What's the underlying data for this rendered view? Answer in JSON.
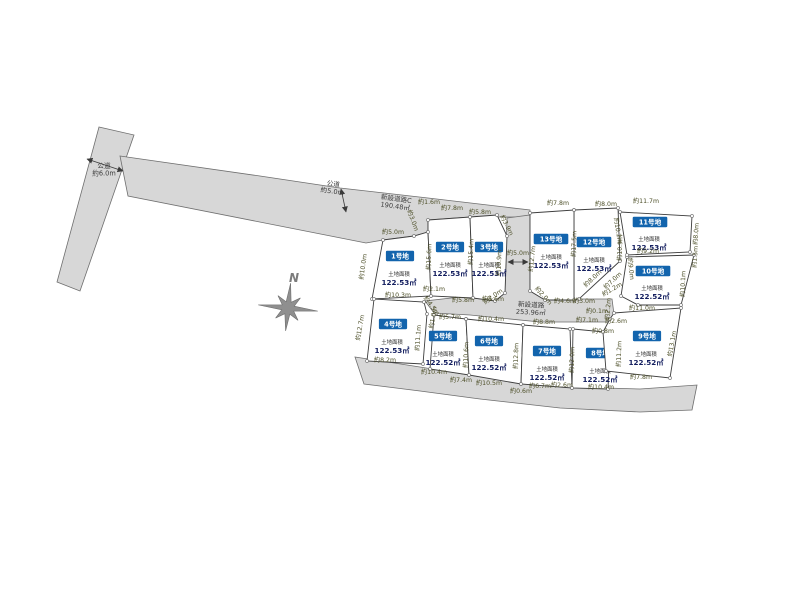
{
  "compass": {
    "label": "N"
  },
  "colors": {
    "road_fill": "#d7d7d7",
    "road_stroke": "#6e6e6e",
    "plot_fill": "#ffffff",
    "plot_stroke": "#3d3d3d",
    "chip_bg": "#1264ad",
    "chip_text": "#ffffff",
    "dim_text": "#4d4f28",
    "area_value_text": "#121d5e",
    "compass_gray": "#8f8f8f"
  },
  "roads": [
    {
      "name": "public-road-6m-band",
      "points": [
        [
          99,
          127
        ],
        [
          134,
          135
        ],
        [
          80,
          291
        ],
        [
          57,
          282
        ]
      ]
    },
    {
      "name": "public-road-5m-upper",
      "points": [
        [
          120,
          156
        ],
        [
          260,
          176
        ],
        [
          340,
          188
        ],
        [
          428,
          198
        ],
        [
          530,
          210
        ],
        [
          530,
          217
        ],
        [
          470,
          217
        ],
        [
          428,
          220
        ],
        [
          428,
          232
        ],
        [
          414,
          236
        ],
        [
          383,
          240
        ],
        [
          366,
          243
        ],
        [
          128,
          196
        ]
      ]
    },
    {
      "name": "new-road-vertical-and-middle",
      "points": [
        [
          507,
          218
        ],
        [
          530,
          215
        ],
        [
          530,
          291
        ],
        [
          545,
          300
        ],
        [
          565,
          299
        ],
        [
          612,
          299
        ],
        [
          615,
          322
        ],
        [
          540,
          322
        ],
        [
          470,
          315
        ],
        [
          434,
          313
        ],
        [
          425,
          301
        ],
        [
          460,
          297
        ],
        [
          492,
          300
        ],
        [
          505,
          291
        ]
      ]
    },
    {
      "name": "south-boundary-road-band",
      "points": [
        [
          355,
          357
        ],
        [
          420,
          367
        ],
        [
          500,
          380
        ],
        [
          570,
          387
        ],
        [
          640,
          389
        ],
        [
          697,
          385
        ],
        [
          692,
          410
        ],
        [
          640,
          412
        ],
        [
          560,
          408
        ],
        [
          480,
          399
        ],
        [
          420,
          391
        ],
        [
          364,
          384
        ]
      ]
    }
  ],
  "road_labels": [
    {
      "name": "public-road-6m-label",
      "lines": [
        "公道",
        "約6.0m"
      ],
      "x": 104,
      "y": 168,
      "r": 0
    },
    {
      "name": "public-road-5m-label",
      "lines": [
        "公道",
        "約5.0m"
      ],
      "x": 333,
      "y": 186,
      "r": 8
    },
    {
      "name": "new-road-c-label",
      "lines": [
        "新設道路C",
        "190.48㎡"
      ],
      "x": 396,
      "y": 201,
      "r": 8
    },
    {
      "name": "new-road-label",
      "lines": [
        "新設道路",
        "253.96㎡"
      ],
      "x": 531,
      "y": 307,
      "r": 3
    }
  ],
  "plots": [
    {
      "id": "plot-1",
      "label": "1号地",
      "area_title": "土地面積",
      "area": "122.53㎡",
      "chip": [
        400,
        256
      ],
      "area_pos": [
        399,
        276
      ],
      "points": [
        [
          383,
          240
        ],
        [
          414,
          236
        ],
        [
          428,
          232
        ],
        [
          431,
          296
        ],
        [
          372,
          299
        ]
      ]
    },
    {
      "id": "plot-2",
      "label": "2号地",
      "area_title": "土地面積",
      "area": "122.53㎡",
      "chip": [
        450,
        247
      ],
      "area_pos": [
        450,
        267
      ],
      "points": [
        [
          428,
          220
        ],
        [
          470,
          217
        ],
        [
          473,
          298
        ],
        [
          431,
          296
        ],
        [
          428,
          232
        ]
      ]
    },
    {
      "id": "plot-3",
      "label": "3号地",
      "area_title": "土地面積",
      "area": "122.53㎡",
      "chip": [
        489,
        247
      ],
      "area_pos": [
        489,
        267
      ],
      "points": [
        [
          470,
          217
        ],
        [
          497,
          215
        ],
        [
          507,
          236
        ],
        [
          505,
          293
        ],
        [
          495,
          301
        ],
        [
          473,
          298
        ]
      ]
    },
    {
      "id": "plot-4",
      "label": "4号地",
      "area_title": "土地面積",
      "area": "122.53㎡",
      "chip": [
        393,
        324
      ],
      "area_pos": [
        392,
        344
      ],
      "points": [
        [
          374,
          299
        ],
        [
          424,
          302
        ],
        [
          427,
          314
        ],
        [
          423,
          364
        ],
        [
          367,
          361
        ]
      ]
    },
    {
      "id": "plot-5",
      "label": "5号地",
      "area_title": "土地面積",
      "area": "122.52㎡",
      "chip": [
        443,
        336
      ],
      "area_pos": [
        443,
        356
      ],
      "points": [
        [
          434,
          315
        ],
        [
          466,
          319
        ],
        [
          469,
          375
        ],
        [
          430,
          369
        ]
      ]
    },
    {
      "id": "plot-6",
      "label": "6号地",
      "area_title": "土地面積",
      "area": "122.52㎡",
      "chip": [
        489,
        341
      ],
      "area_pos": [
        489,
        361
      ],
      "points": [
        [
          466,
          319
        ],
        [
          523,
          325
        ],
        [
          521,
          384
        ],
        [
          469,
          375
        ]
      ]
    },
    {
      "id": "plot-7",
      "label": "7号地",
      "area_title": "土地面積",
      "area": "122.52㎡",
      "chip": [
        547,
        351
      ],
      "area_pos": [
        547,
        371
      ],
      "points": [
        [
          523,
          325
        ],
        [
          570,
          329
        ],
        [
          572,
          388
        ],
        [
          521,
          384
        ]
      ]
    },
    {
      "id": "plot-8",
      "label": "8号地",
      "area_title": "土地面積",
      "area": "122.52㎡",
      "chip": [
        600,
        353
      ],
      "area_pos": [
        600,
        373
      ],
      "points": [
        [
          573,
          329
        ],
        [
          605,
          332
        ],
        [
          610,
          339
        ],
        [
          608,
          389
        ],
        [
          572,
          388
        ]
      ]
    },
    {
      "id": "plot-9",
      "label": "9号地",
      "area_title": "土地面積",
      "area": "122.52㎡",
      "chip": [
        647,
        336
      ],
      "area_pos": [
        646,
        356
      ],
      "points": [
        [
          614,
          313
        ],
        [
          681,
          308
        ],
        [
          670,
          378
        ],
        [
          606,
          371
        ],
        [
          603,
          332
        ],
        [
          610,
          319
        ]
      ]
    },
    {
      "id": "plot-10",
      "label": "10号地",
      "area_title": "土地面積",
      "area": "122.52㎡",
      "chip": [
        653,
        271
      ],
      "area_pos": [
        652,
        290
      ],
      "points": [
        [
          627,
          257
        ],
        [
          694,
          255
        ],
        [
          681,
          305
        ],
        [
          638,
          305
        ],
        [
          621,
          296
        ]
      ]
    },
    {
      "id": "plot-11",
      "label": "11号地",
      "area_title": "土地面積",
      "area": "122.53㎡",
      "chip": [
        650,
        222
      ],
      "area_pos": [
        649,
        241
      ],
      "points": [
        [
          620,
          212
        ],
        [
          692,
          216
        ],
        [
          690,
          252
        ],
        [
          627,
          255
        ]
      ]
    },
    {
      "id": "plot-12",
      "label": "12号地",
      "area_title": "土地面積",
      "area": "122.53㎡",
      "chip": [
        594,
        242
      ],
      "area_pos": [
        594,
        262
      ],
      "points": [
        [
          574,
          210
        ],
        [
          618,
          208
        ],
        [
          620,
          261
        ],
        [
          579,
          299
        ],
        [
          574,
          300
        ]
      ]
    },
    {
      "id": "plot-13",
      "label": "13号地",
      "area_title": "土地面積",
      "area": "122.53㎡",
      "chip": [
        551,
        239
      ],
      "area_pos": [
        551,
        259
      ],
      "points": [
        [
          530,
          213
        ],
        [
          574,
          210
        ],
        [
          574,
          300
        ],
        [
          545,
          300
        ],
        [
          530,
          291
        ]
      ]
    }
  ],
  "dims": [
    {
      "t": "約5.0m",
      "x": 393,
      "y": 234,
      "r": 0
    },
    {
      "t": "約1.6m",
      "x": 429,
      "y": 204,
      "r": 0
    },
    {
      "t": "約7.8m",
      "x": 452,
      "y": 210,
      "r": 0
    },
    {
      "t": "約5.8m",
      "x": 480,
      "y": 214,
      "r": 0
    },
    {
      "t": "約3.9m",
      "x": 505,
      "y": 226,
      "r": 64
    },
    {
      "t": "約3.0m",
      "x": 411,
      "y": 221,
      "r": 70
    },
    {
      "t": "約7.8m",
      "x": 558,
      "y": 205,
      "r": 0
    },
    {
      "t": "約8.0m",
      "x": 606,
      "y": 206,
      "r": 0
    },
    {
      "t": "約11.7m",
      "x": 646,
      "y": 203,
      "r": 0
    },
    {
      "t": "約10.0m",
      "x": 365,
      "y": 267,
      "r": -82
    },
    {
      "t": "約15.6m",
      "x": 431,
      "y": 257,
      "r": -88
    },
    {
      "t": "約15.4m",
      "x": 473,
      "y": 252,
      "r": -88
    },
    {
      "t": "約10.9m",
      "x": 501,
      "y": 263,
      "r": -88
    },
    {
      "t": "約12.7m",
      "x": 534,
      "y": 259,
      "r": -84
    },
    {
      "t": "約17.5m",
      "x": 576,
      "y": 244,
      "r": -88
    },
    {
      "t": "約10.9m",
      "x": 622,
      "y": 248,
      "r": -88
    },
    {
      "t": "約10.2m",
      "x": 616,
      "y": 231,
      "r": 81
    },
    {
      "t": "約8.0m",
      "x": 698,
      "y": 234,
      "r": -86
    },
    {
      "t": "約1.5m",
      "x": 697,
      "y": 257,
      "r": -86
    },
    {
      "t": "約10.1m",
      "x": 685,
      "y": 284,
      "r": -88
    },
    {
      "t": "約9.0m",
      "x": 629,
      "y": 269,
      "r": 84
    },
    {
      "t": "約9.2m",
      "x": 648,
      "y": 253,
      "r": 0
    },
    {
      "t": "約10.3m",
      "x": 398,
      "y": 297,
      "r": 0
    },
    {
      "t": "約2.1m",
      "x": 434,
      "y": 291,
      "r": 0
    },
    {
      "t": "約5.8m",
      "x": 463,
      "y": 302,
      "r": 0
    },
    {
      "t": "約6.6m",
      "x": 493,
      "y": 301,
      "r": 0
    },
    {
      "t": "約4.5m",
      "x": 430,
      "y": 307,
      "r": 53
    },
    {
      "t": "約1.0m",
      "x": 435,
      "y": 318,
      "r": -80
    },
    {
      "t": "約2.0m",
      "x": 494,
      "y": 298,
      "r": -35
    },
    {
      "t": "約2.0m",
      "x": 542,
      "y": 297,
      "r": 48
    },
    {
      "t": "約5.0m",
      "x": 518,
      "y": 255,
      "r": 0
    },
    {
      "t": "約4.6m",
      "x": 565,
      "y": 303,
      "r": 0
    },
    {
      "t": "約3.0m",
      "x": 584,
      "y": 303,
      "r": 0
    },
    {
      "t": "約0.1m",
      "x": 597,
      "y": 313,
      "r": 0
    },
    {
      "t": "約7.1m",
      "x": 587,
      "y": 322,
      "r": 0
    },
    {
      "t": "約0.8m",
      "x": 603,
      "y": 333,
      "r": 0
    },
    {
      "t": "約2.6m",
      "x": 616,
      "y": 323,
      "r": 0
    },
    {
      "t": "約8.0m",
      "x": 594,
      "y": 280,
      "r": -43
    },
    {
      "t": "約7.0m",
      "x": 614,
      "y": 282,
      "r": -43
    },
    {
      "t": "約1.2m",
      "x": 613,
      "y": 291,
      "r": -30
    },
    {
      "t": "約2.2m",
      "x": 610,
      "y": 309,
      "r": -85
    },
    {
      "t": "約11.0m",
      "x": 642,
      "y": 310,
      "r": 0
    },
    {
      "t": "約12.7m",
      "x": 362,
      "y": 328,
      "r": -80
    },
    {
      "t": "約11.1m",
      "x": 420,
      "y": 338,
      "r": -86
    },
    {
      "t": "約5.7m",
      "x": 450,
      "y": 319,
      "r": 0
    },
    {
      "t": "約10.4m",
      "x": 491,
      "y": 321,
      "r": 0
    },
    {
      "t": "約10.6m",
      "x": 468,
      "y": 355,
      "r": -88
    },
    {
      "t": "約12.8m",
      "x": 518,
      "y": 356,
      "r": -88
    },
    {
      "t": "約8.8m",
      "x": 544,
      "y": 324,
      "r": 0
    },
    {
      "t": "約12.0m",
      "x": 574,
      "y": 360,
      "r": -88
    },
    {
      "t": "約11.2m",
      "x": 621,
      "y": 354,
      "r": -88
    },
    {
      "t": "約13.1m",
      "x": 674,
      "y": 344,
      "r": -80
    },
    {
      "t": "約8.2m",
      "x": 385,
      "y": 362,
      "r": 0
    },
    {
      "t": "約10.4m",
      "x": 434,
      "y": 374,
      "r": 0
    },
    {
      "t": "約7.4m",
      "x": 461,
      "y": 382,
      "r": 0
    },
    {
      "t": "約10.5m",
      "x": 489,
      "y": 385,
      "r": 0
    },
    {
      "t": "約0.6m",
      "x": 521,
      "y": 393,
      "r": 0
    },
    {
      "t": "約6.7m",
      "x": 540,
      "y": 388,
      "r": 0
    },
    {
      "t": "約2.6m",
      "x": 562,
      "y": 387,
      "r": 0
    },
    {
      "t": "約10.4m",
      "x": 601,
      "y": 389,
      "r": 0
    },
    {
      "t": "約7.8m",
      "x": 641,
      "y": 379,
      "r": 0
    }
  ],
  "arrows": [
    {
      "name": "width-arrow-6m",
      "p": [
        87,
        159,
        123,
        171
      ]
    },
    {
      "name": "width-arrow-5m-upper",
      "p": [
        341,
        189,
        346,
        212
      ]
    },
    {
      "name": "width-arrow-5m-vertical",
      "p": [
        508,
        262,
        528,
        262
      ]
    }
  ]
}
